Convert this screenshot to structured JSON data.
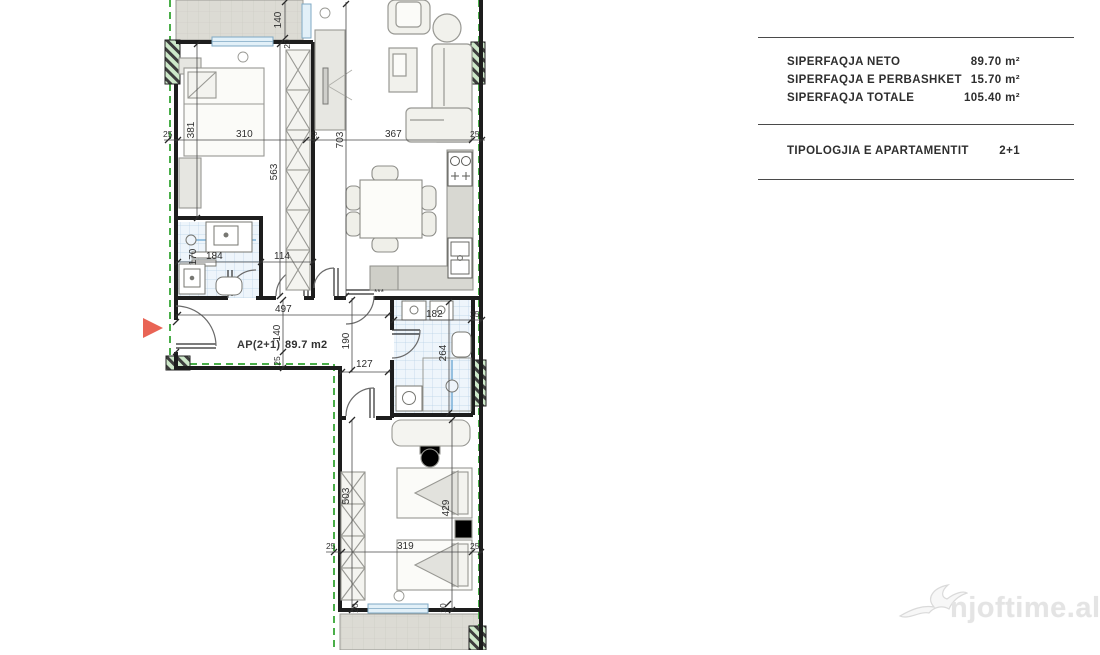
{
  "panel": {
    "rows": [
      {
        "label": "SIPERFAQJA NETO",
        "value": "89.70 m²"
      },
      {
        "label": "SIPERFAQJA E PERBASHKET",
        "value": "15.70 m²"
      },
      {
        "label": "SIPERFAQJA TOTALE",
        "value": "105.40 m²"
      }
    ],
    "typology_label": "TIPOLOGJIA E APARTAMENTIT",
    "typology_value": "2+1"
  },
  "plan": {
    "unit_label": "AP(2+1)",
    "area_value": "89.7 m2",
    "stars": "***",
    "dims": {
      "d140_balcony": "140",
      "d20_balcony": "20",
      "d25_tl": "25",
      "d381": "381",
      "d310": "310",
      "d20_top": "20",
      "d563": "563",
      "d703": "703",
      "d367": "367",
      "d25_tr": "25",
      "d170": "170",
      "d184": "184",
      "d114": "114",
      "d497": "497",
      "d140_corr": "140",
      "d25_corr": "25",
      "d190": "190",
      "d127": "127",
      "d182": "182",
      "d25_bath2": "25",
      "d264": "264",
      "d503": "503",
      "d429": "429",
      "d25_bl": "25",
      "d319": "319",
      "d25_br": "25",
      "d20_w1": "20",
      "d20_w2": "20"
    }
  },
  "watermark": {
    "text": "njoftime.al"
  },
  "colors": {
    "accent_red": "#c43527",
    "arrow_red": "#e96455",
    "boundary_green": "#4aae49",
    "wall_black": "#1d1d1d",
    "tile_line": "#b9d2e6",
    "balcony_fill": "#dcdbd4",
    "watermark_gray": "#e4e4e4"
  }
}
